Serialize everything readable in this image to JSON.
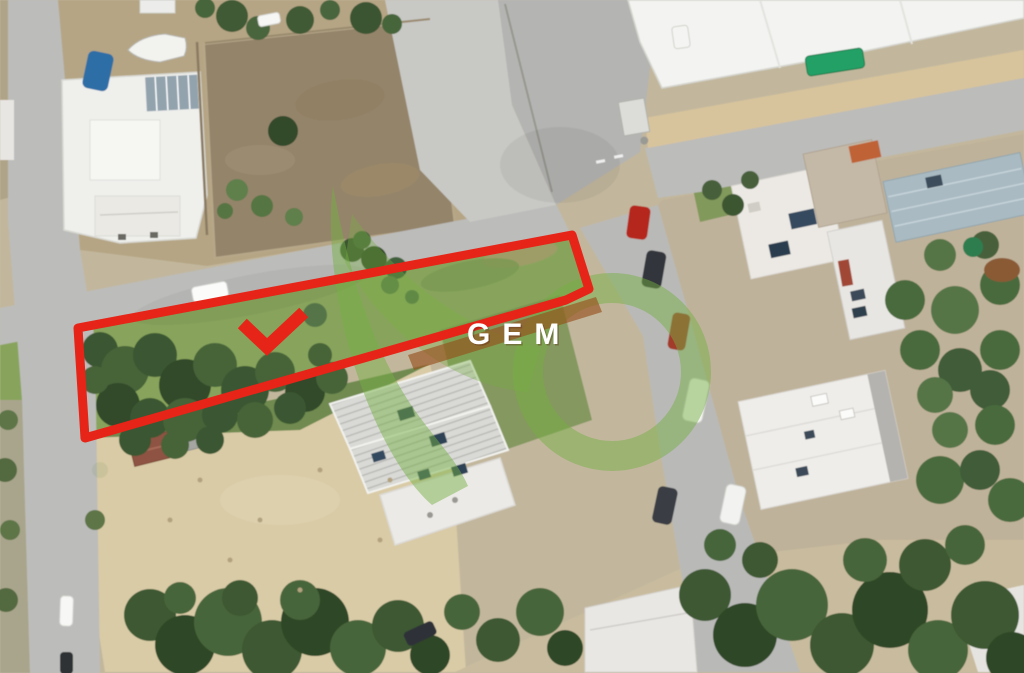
{
  "image": {
    "kind": "satellite-aerial-photo-with-property-annotation",
    "width": 1024,
    "height": 673
  },
  "watermark": {
    "text": "GEM",
    "text_color": "#ffffff",
    "text_shadow_color": "rgba(90,35,20,0.35)",
    "logo_green_rgba": "rgba(118,175,66,0.48)",
    "band_orange_rgba": "rgba(150,76,24,0.62)"
  },
  "annotation": {
    "color": "#e62418",
    "stroke_width": 9,
    "plot_outline_points": "78,328 572,235 589,289 566,300 85,438",
    "checkmark_points": "247,328 267,347 299,317",
    "checkmark_stroke_width": 13
  },
  "palette": {
    "road": "#bcbcba",
    "concrete_pad": "#c8c8c4",
    "ground_tan": "#b5a584",
    "field_brown": "#94846a",
    "sand": "#d9cba6",
    "plot_grass": "#88a45c",
    "sidewalk_tan": "#d8c49c",
    "building_white": "#f3f3f1",
    "blue_roof": "#a9bac2",
    "tree_dark": "#3a5630",
    "tree_mid": "#47653a"
  },
  "scene_features": [
    "left-vertical-road",
    "main-road-west",
    "road-north",
    "road-east",
    "road-south",
    "industrial-building-top-right",
    "house-top-left",
    "boat",
    "blue-tarp",
    "bare-brown-field",
    "fenced-plot-with-red-outline",
    "dense-plot-trees",
    "apartment-building-ribbed-roof",
    "row-of-houses-east",
    "sand-lot",
    "olive-tree-row-bottom",
    "parked-cars",
    "green-waste-container"
  ]
}
